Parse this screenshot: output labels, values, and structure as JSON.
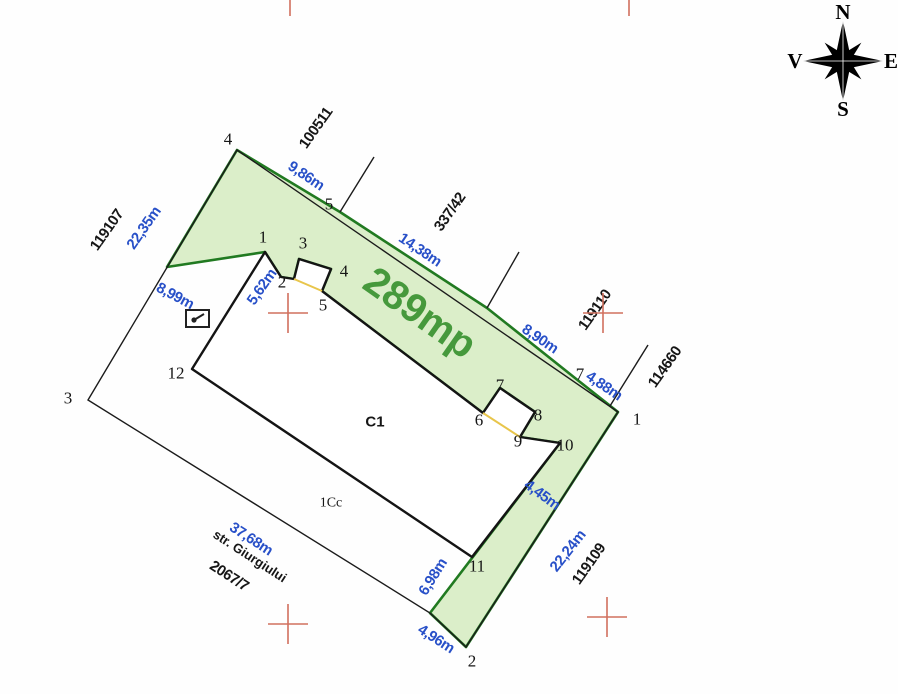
{
  "map": {
    "area_label": "289mp",
    "building_label": "C1",
    "yard_label": "1Cc",
    "street_name": "str. Giurgiului",
    "street_parcel_id": "2067/7"
  },
  "neighbors": {
    "west": "119107",
    "north": "100511",
    "northeast": "337/42",
    "east_upper": "119110",
    "east_lower": "114660",
    "southeast": "119109"
  },
  "dimensions": {
    "side_west": "22,35m",
    "side_west_lower": "8,99m",
    "cluster": "5,62m",
    "top_1": "9,86m",
    "top_2": "14,38m",
    "top_3": "8,90m",
    "top_4": "4,88m",
    "strip_upper": "4,45m",
    "strip_long": "22,24m",
    "strip_lower": "6,98m",
    "bottom_edge": "4,96m",
    "street_front": "37,68m"
  },
  "points": {
    "p1": "1",
    "p2": "2",
    "p3": "3",
    "p4": "4",
    "p5": "5",
    "p6": "6",
    "p7": "7",
    "p8": "8",
    "p9": "9",
    "p10": "10",
    "p11": "11",
    "p12": "12"
  },
  "compass": {
    "north": "N",
    "east": "E",
    "south": "S",
    "west": "V"
  },
  "colors": {
    "parcel_fill": "#dbeec9",
    "parcel_border": "#217a21",
    "area_text": "#46993c",
    "dimension_text": "#2850c8",
    "survey_cross": "#d1705e",
    "notch_line": "#e8c54b"
  }
}
